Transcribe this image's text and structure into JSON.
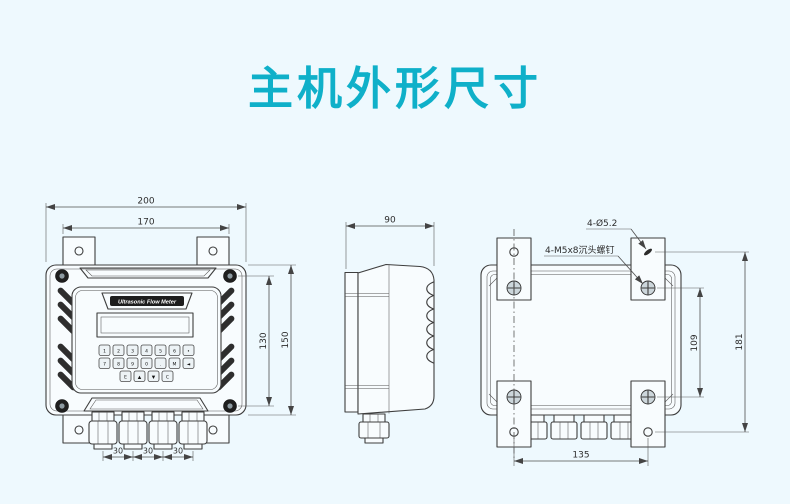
{
  "title": "主机外形尺寸",
  "colors": {
    "accent": "#0fb0c9",
    "background": "#eef9fe",
    "line": "#3e3e3e"
  },
  "front_view": {
    "device_label": "Ultrasonic Flow Meter",
    "dim_width_outer": "200",
    "dim_width_tabs": "170",
    "dim_height_body": "150",
    "dim_height_screws": "130",
    "dim_gland_spacing": [
      "30",
      "30",
      "30"
    ],
    "keypad": {
      "row1": [
        "1",
        "2",
        "3",
        "4",
        "5",
        "6",
        "•"
      ],
      "row2": [
        "7",
        "8",
        "9",
        "0",
        ".",
        "M",
        "◄"
      ],
      "row3": [
        "E",
        "▲",
        "▼",
        "C"
      ]
    }
  },
  "side_view": {
    "dim_depth": "90"
  },
  "back_view": {
    "note_holes": "4-Ø5.2",
    "note_screws": "4-M5x8沉头螺钉",
    "dim_screw_spacing_v": "109",
    "dim_hole_spacing_v": "181",
    "dim_hole_spacing_h": "135"
  }
}
